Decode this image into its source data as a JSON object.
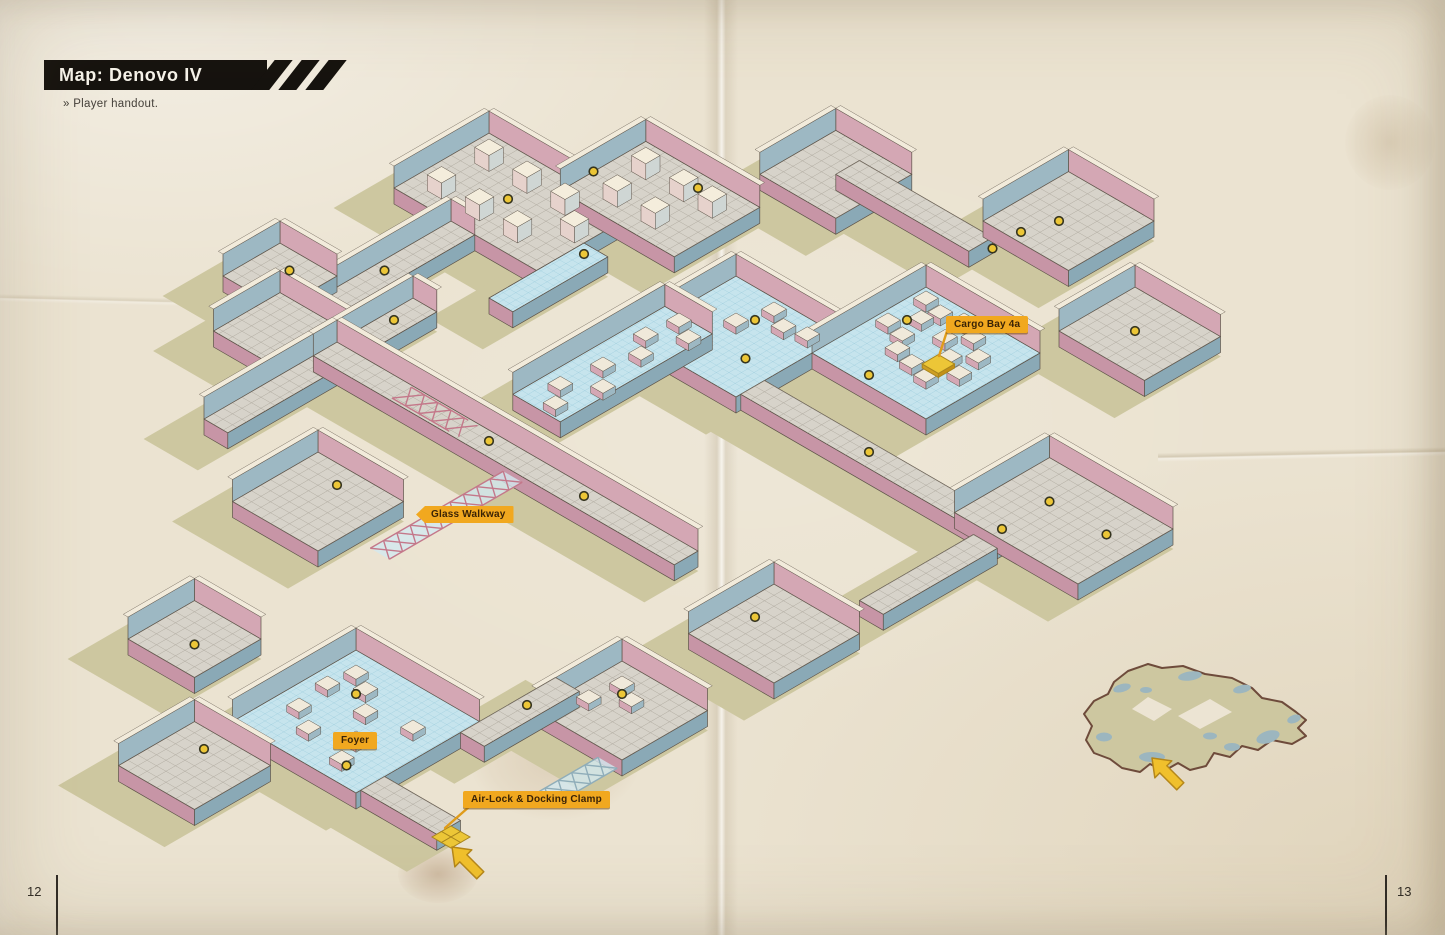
{
  "header": {
    "title": "Map: Denovo IV",
    "subtitle": "» Player handout."
  },
  "map_labels": {
    "cargo_bay": "Cargo Bay 4a",
    "glass_walkway": "Glass Walkway",
    "foyer": "Foyer",
    "airlock": "Air-Lock & Docking Clamp"
  },
  "footer": {
    "left_page": "12",
    "right_page": "13"
  },
  "icons": {
    "entry_arrow": "entry-arrow",
    "door_marker": "door-dot",
    "airlock_pad": "airlock-tiles",
    "hazard_stripes": "hazard-stripes"
  },
  "colors": {
    "paper": "#ebe3d1",
    "hull_shadow": "#cdc7a0",
    "floor_blue": "#c6e4ed",
    "floor_blue_grid": "#8cc3d6",
    "floor_gray": "#d7d3ca",
    "floor_gray_grid": "#a39e92",
    "wall_pink": "#d4a7b4",
    "wall_pink_dark": "#c795a6",
    "wall_slate": "#9db8c3",
    "wall_slate_dark": "#8aa9b6",
    "wall_top_cream": "#f2ebdb",
    "outline": "#5d5348",
    "door_yellow": "#ecc637",
    "label_orange": "#f1a81f",
    "label_text": "#3a2306",
    "ink": "#26221d"
  }
}
